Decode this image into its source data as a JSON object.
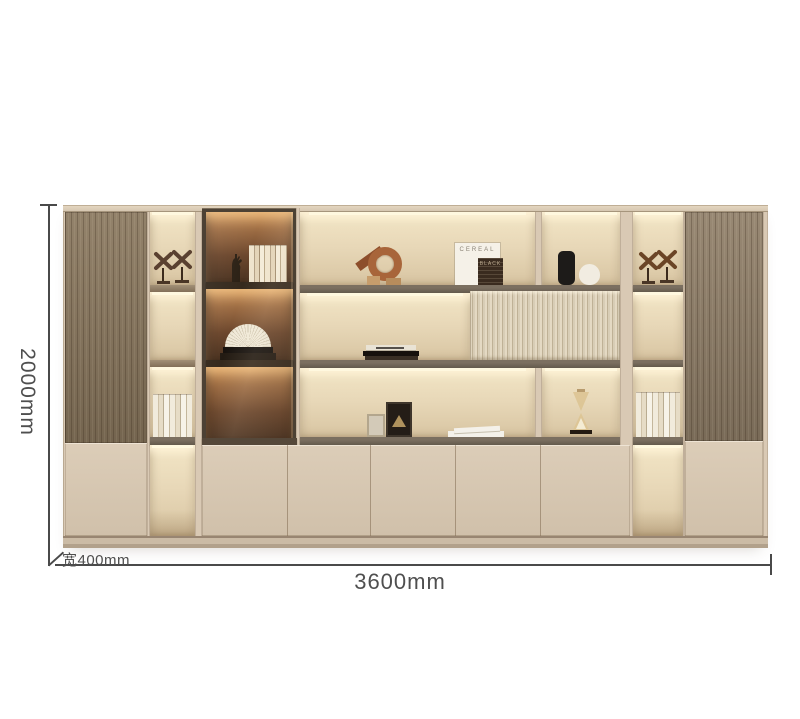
{
  "annotations": {
    "height": "2000mm",
    "width": "3600mm",
    "depth": "宽400mm"
  },
  "decor_text": {
    "magazine": "CEREAL",
    "book": "BLACK"
  },
  "furnishings": [
    "x-wine-rack-sculptures",
    "book-rows",
    "hand-sculpture",
    "open-fan-book-on-stack",
    "copper-spiral-sculpture",
    "cereal-magazine",
    "black-book",
    "black-vase",
    "white-vase",
    "flat-book-stack",
    "photo-frames",
    "white-open-book",
    "hourglass"
  ],
  "palette": {
    "background": "#ffffff",
    "cabinet_beige": "#d9c9b4",
    "door_beige": "#d6c5b0",
    "wood": "#87755c",
    "wood_right": "#8d7c66",
    "shelf_dark": "#645a4c",
    "niche_light": "#e7d7b7",
    "led_glow": "#fff4d8",
    "glass_amber": "#6b462c",
    "fluted": "#ddd2bb",
    "dimension_line": "#4a4a4a",
    "dimension_text": "#4f4f4f"
  }
}
